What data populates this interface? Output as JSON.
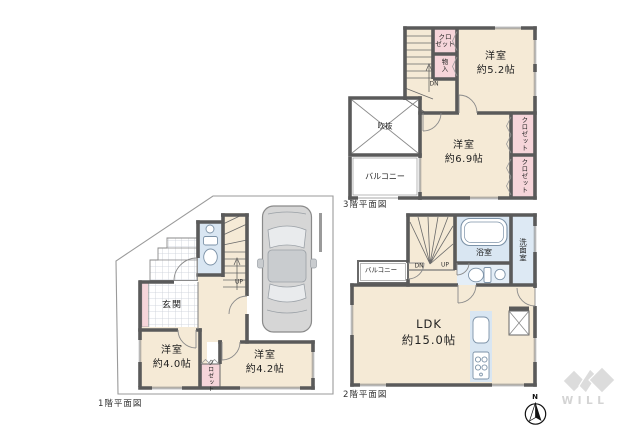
{
  "palette": {
    "wall": "#5a5a5a",
    "room_fill": "#f5ead6",
    "closet_fill": "#f6d5da",
    "wet_area_fill": "#d9e6f2",
    "balcony_fill": "#ffffff",
    "boundary_line": "#9a9a9a",
    "label_text": "#222222",
    "logo_gray": "#d9d9d9"
  },
  "floor3": {
    "caption": "3階平面図",
    "rooms": {
      "bedroom52": {
        "name": "洋室",
        "size": "約5.2帖"
      },
      "bedroom69": {
        "name": "洋室",
        "size": "約6.9帖"
      }
    },
    "labels": {
      "closet": "クロ\nゼット",
      "storage": "物\n入",
      "void": "吹抜",
      "balcony": "バルコニー",
      "closet_right_upper": "クロゼット",
      "closet_right_lower": "クロゼット",
      "stairs_down": "DN"
    }
  },
  "floor2": {
    "caption": "2階平面図",
    "rooms": {
      "ldk": {
        "name": "LDK",
        "size": "約15.0帖"
      }
    },
    "labels": {
      "bath": "浴室",
      "washroom": "洗面室",
      "balcony": "バルコニー",
      "stairs_down": "DN",
      "stairs_up": "UP"
    }
  },
  "floor1": {
    "caption": "1階平面図",
    "rooms": {
      "bedroom40": {
        "name": "洋室",
        "size": "約4.0帖"
      },
      "bedroom42": {
        "name": "洋室",
        "size": "約4.2帖"
      }
    },
    "labels": {
      "entrance": "玄関",
      "closet": "クロゼット",
      "stairs_up": "UP"
    }
  },
  "compass": {
    "north": "N"
  },
  "logo": {
    "text": "WILL"
  }
}
